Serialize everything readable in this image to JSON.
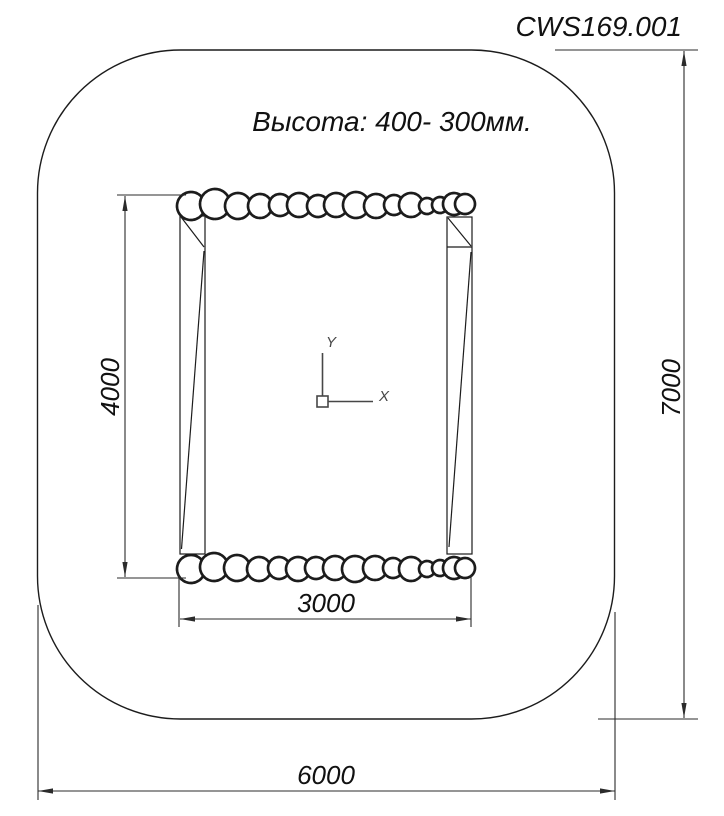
{
  "title": {
    "drawing_number": "CWS169.001"
  },
  "note": {
    "height_label": "Высота: 400- 300мм."
  },
  "dimensions": {
    "inner_width": "3000",
    "inner_height": "4000",
    "outer_width": "6000",
    "outer_height": "7000"
  },
  "ucs": {
    "x_label": "X",
    "y_label": "Y"
  },
  "colors": {
    "line": "#1c1c1c",
    "dim": "#2b2b2b",
    "ucs": "#474747",
    "bg": "#ffffff",
    "text": "#111111"
  },
  "stones": {
    "top": [
      {
        "cx": 191,
        "cy": 206,
        "r": 14
      },
      {
        "cx": 215,
        "cy": 204,
        "r": 15
      },
      {
        "cx": 238,
        "cy": 206,
        "r": 13
      },
      {
        "cx": 260,
        "cy": 206,
        "r": 12
      },
      {
        "cx": 280,
        "cy": 205,
        "r": 11
      },
      {
        "cx": 299,
        "cy": 205,
        "r": 12
      },
      {
        "cx": 318,
        "cy": 206,
        "r": 11
      },
      {
        "cx": 336,
        "cy": 205,
        "r": 12
      },
      {
        "cx": 356,
        "cy": 205,
        "r": 13
      },
      {
        "cx": 376,
        "cy": 206,
        "r": 12
      },
      {
        "cx": 394,
        "cy": 205,
        "r": 10
      },
      {
        "cx": 411,
        "cy": 205,
        "r": 12
      },
      {
        "cx": 427,
        "cy": 206,
        "r": 8
      },
      {
        "cx": 440,
        "cy": 205,
        "r": 8
      },
      {
        "cx": 454,
        "cy": 204,
        "r": 11
      },
      {
        "cx": 465,
        "cy": 204,
        "r": 10
      }
    ],
    "bottom": [
      {
        "cx": 191,
        "cy": 569,
        "r": 14
      },
      {
        "cx": 214,
        "cy": 567,
        "r": 14
      },
      {
        "cx": 237,
        "cy": 568,
        "r": 13
      },
      {
        "cx": 259,
        "cy": 569,
        "r": 12
      },
      {
        "cx": 279,
        "cy": 568,
        "r": 11
      },
      {
        "cx": 298,
        "cy": 569,
        "r": 12
      },
      {
        "cx": 316,
        "cy": 568,
        "r": 11
      },
      {
        "cx": 335,
        "cy": 568,
        "r": 12
      },
      {
        "cx": 355,
        "cy": 569,
        "r": 13
      },
      {
        "cx": 375,
        "cy": 568,
        "r": 12
      },
      {
        "cx": 393,
        "cy": 568,
        "r": 10
      },
      {
        "cx": 411,
        "cy": 569,
        "r": 12
      },
      {
        "cx": 427,
        "cy": 569,
        "r": 8
      },
      {
        "cx": 440,
        "cy": 568,
        "r": 8
      },
      {
        "cx": 454,
        "cy": 568,
        "r": 11
      },
      {
        "cx": 465,
        "cy": 568,
        "r": 10
      }
    ]
  }
}
